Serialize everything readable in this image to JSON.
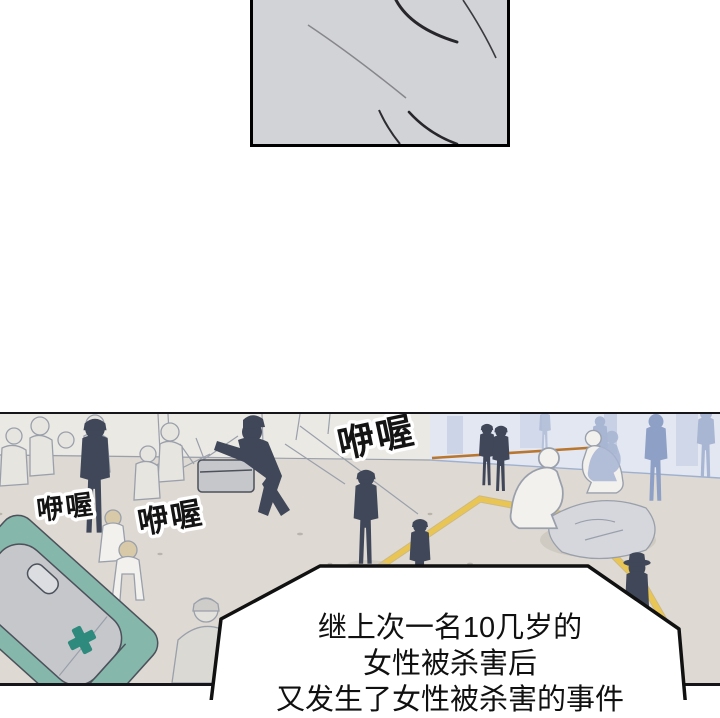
{
  "page": {
    "kind": "webtoon comic page",
    "background": "#ffffff"
  },
  "top_panel": {
    "content": "empty gray panel with sketch curves, cropped by top edge"
  },
  "scene_panel": {
    "content": "street crime scene: police officers holding back onlookers, forensics crouching over covered body behind police-line tape, teal car with cross mark"
  },
  "sfx": {
    "items": [
      {
        "text": "咿喔"
      },
      {
        "text": "咿喔"
      },
      {
        "text": "咿喔"
      }
    ]
  },
  "speech_bubble": {
    "line1": "继上次一名10几岁的",
    "line2": "女性被杀害后",
    "line3": "又发生了女性被杀害的事件"
  },
  "colors": {
    "panelgray": "#d2d3d6",
    "ground": "#ded9d2",
    "wall": "#ebe9e4",
    "bluewall": "#e2e7f2",
    "bluewall2": "#c7d0e4",
    "police": "#3f4759",
    "bluefig": "#a8b5d3",
    "bluefig2": "#8fa0c6",
    "tape": "#e9c654",
    "curb": "#b9762f",
    "carbody": "#85b7aa",
    "carroof": "#c6c7cb",
    "carcross": "#2e8a7c",
    "sheet": "#d6d7dc",
    "sketch": "#4c515b",
    "sketchlight": "#9aa0ab",
    "paper": "#f2f1ee",
    "hair": "#d8c9a8",
    "ink": "#111111"
  }
}
